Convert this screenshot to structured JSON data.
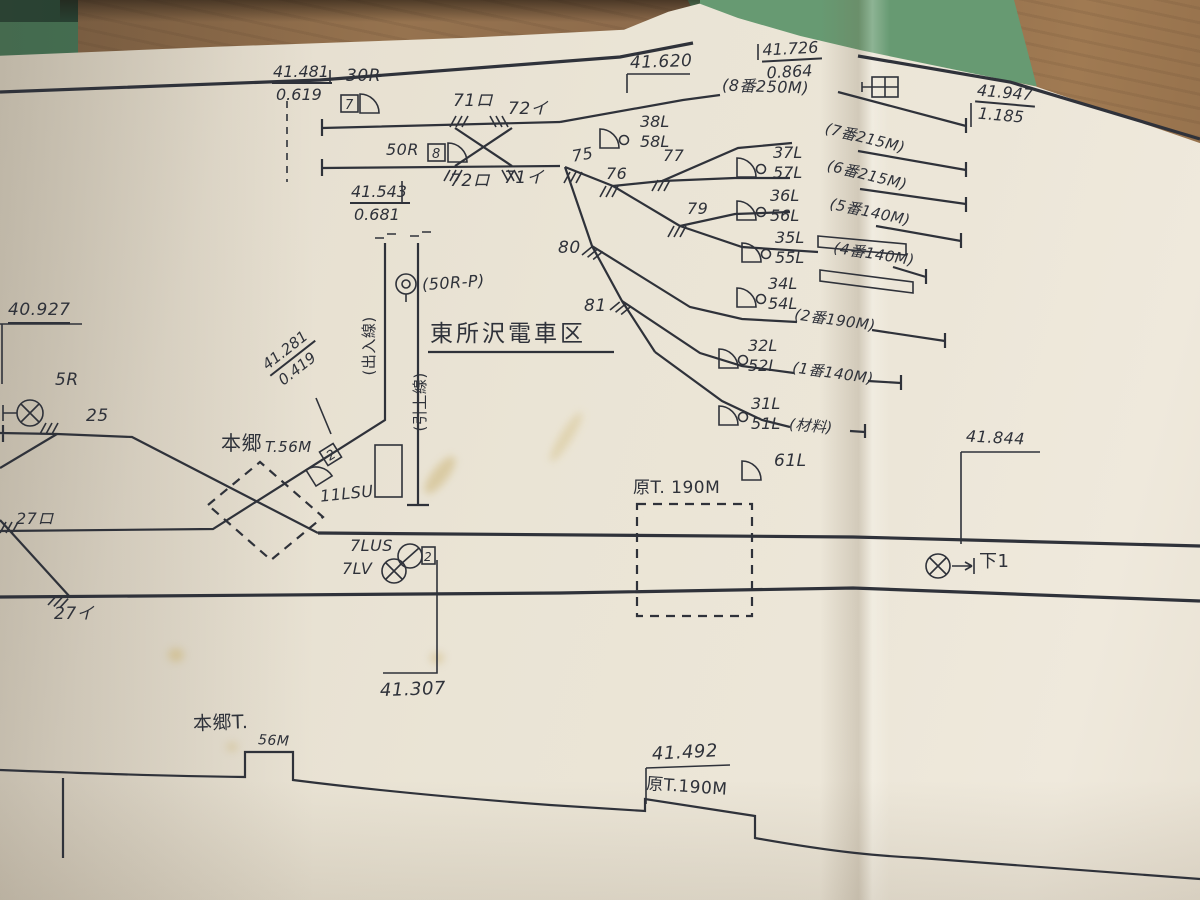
{
  "colors": {
    "ink": "#2f323a",
    "paper": "#eae4d6",
    "wood": "#8e6c4e",
    "mat_green": "#679a72",
    "book_green": "#2f5c44"
  },
  "depot": {
    "name": "東所沢電車区"
  },
  "chainages": {
    "c41481": {
      "km": "41.481",
      "grade": "0.619"
    },
    "c41543": {
      "km": "41.543",
      "grade": "0.681"
    },
    "c41620": {
      "km": "41.620"
    },
    "c41726": {
      "km": "41.726",
      "grade": "0.864"
    },
    "c41947": {
      "km": "41.947",
      "grade": "1.185"
    },
    "c40927": {
      "km": "40.927"
    },
    "c41281": {
      "km": "41.281",
      "grade": "0.419"
    },
    "c41844": {
      "km": "41.844"
    },
    "c41307": {
      "km": "41.307"
    },
    "c41492": {
      "km": "41.492"
    }
  },
  "signals": {
    "s30R": {
      "label": "30R",
      "box": "7"
    },
    "s50R": {
      "label": "50R",
      "box": "8"
    },
    "s38": {
      "top": "38L",
      "bottom": "58L"
    },
    "s37": {
      "top": "37L",
      "bottom": "57L"
    },
    "s36": {
      "top": "36L",
      "bottom": "56L"
    },
    "s35": {
      "top": "35L",
      "bottom": "55L"
    },
    "s34": {
      "top": "34L",
      "bottom": "54L"
    },
    "s32": {
      "top": "32L",
      "bottom": "52L"
    },
    "s31": {
      "top": "31L",
      "bottom": "51L"
    },
    "s61": {
      "label": "61L"
    },
    "s11LSU": {
      "label": "11LSU",
      "box": "2"
    },
    "s7LUS": {
      "label": "7LUS",
      "box": "2"
    },
    "s7LV": {
      "label": "7LV"
    },
    "s5R": {
      "label": "5R"
    },
    "s50RP": {
      "label": "(50R-P)"
    },
    "shita1": {
      "label": "下1"
    }
  },
  "turnouts": {
    "t71ro": "71ロ",
    "t72i": "72イ",
    "t72ro": "72ロ",
    "t71i": "71イ",
    "t75": "75",
    "t76": "76",
    "t77": "77",
    "t79": "79",
    "t80": "80",
    "t81": "81",
    "t25": "25",
    "t27ro": "27ロ",
    "t27i": "27イ"
  },
  "platforms": {
    "p8": "(8番250M)",
    "p7": "(7番215M)",
    "p6": "(6番215M)",
    "p5": "(5番140M)",
    "p4": "(4番140M)",
    "p2": "(2番190M)",
    "p1": "(1番140M)",
    "pmat": "(材料)"
  },
  "sidings": {
    "deiri": "(出入線)",
    "hikiage": "(引上線)"
  },
  "tunnels": {
    "hongo_top_name": "本郷",
    "hongo_top_len": "T.56M",
    "hara_top": "原T. 190M",
    "hongo_bot_name": "本郷T.",
    "hongo_bot_len": "56M",
    "hara_bot": "原T.190M"
  }
}
